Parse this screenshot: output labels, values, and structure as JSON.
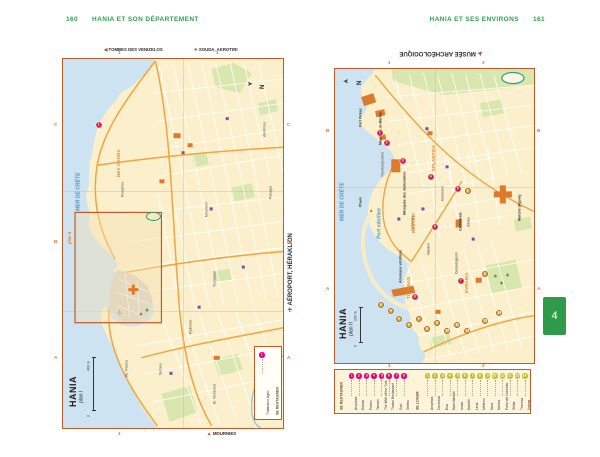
{
  "page": {
    "left_header": {
      "page_number": "160",
      "title": "HANIA ET SON DÉPARTEMENT"
    },
    "right_header": {
      "title": "HANIA ET SES ENVIRONS",
      "page_number": "161"
    },
    "section_tab": "4"
  },
  "colors": {
    "header_green": "#2e9f4d",
    "tab_green": "#2f9b4a",
    "map_border": "#c05a28",
    "sea": "#cde3f1",
    "land": "#fbf0cb",
    "park": "#d9e6ae",
    "building": "#dd7a2c",
    "restaurant_marker": "#e6007e",
    "hotel_marker": "#bcc03a",
    "grid_label": "#e2762d"
  },
  "maps": {
    "left": {
      "title": "HANIA",
      "subtitle": "plan I",
      "compass": "N",
      "scale": {
        "zero": "0",
        "max": "400 m"
      },
      "inset_label": "plan II",
      "edge": {
        "top_left_arrow": "◀",
        "top_left": "TOMBES DES VENIZELOS",
        "top_right_icon": "✈",
        "top_right": "SOUDA, AKROTIRI",
        "right_icon": "✈",
        "right": "AÉROPORT, HÉRAKLION",
        "bottom_icon": "➤",
        "bottom": "MOURNIES"
      },
      "grid": {
        "rows": [
          "C",
          "B",
          "A"
        ],
        "cols": [
          "1",
          "2"
        ]
      },
      "sea_labels": [
        {
          "t": "MER DE CRÈTE",
          "x": 13,
          "y": 152
        }
      ],
      "area_labels": [
        {
          "t": "NEA CHORA",
          "x": 54,
          "y": 118
        }
      ],
      "street_labels": [
        {
          "t": "Kissamou",
          "x": 58,
          "y": 138
        },
        {
          "t": "Akrotiriou",
          "x": 200,
          "y": 78
        },
        {
          "t": "Panagia",
          "x": 206,
          "y": 140
        },
        {
          "t": "Mournion",
          "x": 142,
          "y": 158
        },
        {
          "t": "Tzanakaki",
          "x": 150,
          "y": 228
        },
        {
          "t": "Kydonias",
          "x": 126,
          "y": 275
        },
        {
          "t": "El. Venizelou",
          "x": 150,
          "y": 345
        },
        {
          "t": "Ap. Pavlou",
          "x": 62,
          "y": 318
        },
        {
          "t": "Selinou",
          "x": 96,
          "y": 316
        },
        {
          "t": "Ag. Gogoni",
          "x": 200,
          "y": 308
        }
      ],
      "poi_labels": [],
      "legend": {
        "header": "SE RESTAURER",
        "entries": [
          {
            "n": "1",
            "name": "Thalassino Ageri"
          }
        ]
      },
      "restaurant_markers": [
        {
          "x": 36,
          "y": 66,
          "n": "1"
        }
      ],
      "hotel_markers": []
    },
    "right": {
      "title": "HANIA",
      "subtitle": "plan II",
      "compass": "N",
      "scale": {
        "zero": "0",
        "max": "200 m"
      },
      "edge": {
        "top": "MUSÉE ARCHÉOLOGIQUE",
        "top_icon": "➤"
      },
      "grid": {
        "rows": [
          "B",
          "A"
        ],
        "cols": [
          "1",
          "2"
        ]
      },
      "sea_labels": [
        {
          "t": "MER DE CRÈTE",
          "x": 5,
          "y": 152
        },
        {
          "t": "Port vénitien",
          "x": 42,
          "y": 170
        }
      ],
      "area_labels": [
        {
          "t": "SPLANTZIA",
          "x": 97,
          "y": 102
        },
        {
          "t": "KASTELI",
          "x": 77,
          "y": 164
        },
        {
          "t": "TOPANAS",
          "x": 72,
          "y": 230
        },
        {
          "t": "EVRAIKA",
          "x": 130,
          "y": 224
        }
      ],
      "street_labels": [
        {
          "t": "Theotokopoulou",
          "x": 46,
          "y": 108
        },
        {
          "t": "Kanevaro",
          "x": 106,
          "y": 132
        },
        {
          "t": "Zambeliou",
          "x": 76,
          "y": 162
        },
        {
          "t": "Sifaka",
          "x": 132,
          "y": 158
        },
        {
          "t": "Halidon",
          "x": 92,
          "y": 186
        },
        {
          "t": "Daskalogianni",
          "x": 120,
          "y": 205
        }
      ],
      "poi_labels": [
        {
          "t": "Fort Firkas",
          "x": 24,
          "y": 58
        },
        {
          "t": "Musée de la Marine",
          "x": 44,
          "y": 76
        },
        {
          "t": "Mosquée des Janissaires",
          "x": 68,
          "y": 146
        },
        {
          "t": "Arsenaux vénitiens",
          "x": 64,
          "y": 214
        },
        {
          "t": "Marché (Agora)",
          "x": 183,
          "y": 152
        },
        {
          "t": "Cathédrale",
          "x": 124,
          "y": 162
        },
        {
          "t": "Phare",
          "x": 24,
          "y": 138
        }
      ],
      "restaurant_markers": [
        {
          "x": 45,
          "y": 64,
          "n": "1"
        },
        {
          "x": 52,
          "y": 74,
          "n": "2"
        },
        {
          "x": 68,
          "y": 92,
          "n": "3"
        },
        {
          "x": 96,
          "y": 108,
          "n": "4"
        },
        {
          "x": 123,
          "y": 120,
          "n": "5"
        },
        {
          "x": 100,
          "y": 158,
          "n": "6"
        },
        {
          "x": 126,
          "y": 212,
          "n": "7"
        },
        {
          "x": 80,
          "y": 228,
          "n": "8"
        }
      ],
      "hotel_markers": [
        {
          "x": 133,
          "y": 122,
          "n": "1"
        },
        {
          "x": 150,
          "y": 205,
          "n": "2"
        },
        {
          "x": 46,
          "y": 236,
          "n": "3"
        },
        {
          "x": 56,
          "y": 242,
          "n": "4"
        },
        {
          "x": 64,
          "y": 250,
          "n": "5"
        },
        {
          "x": 74,
          "y": 256,
          "n": "6"
        },
        {
          "x": 84,
          "y": 250,
          "n": "7"
        },
        {
          "x": 92,
          "y": 260,
          "n": "8"
        },
        {
          "x": 102,
          "y": 254,
          "n": "9"
        },
        {
          "x": 112,
          "y": 262,
          "n": "10"
        },
        {
          "x": 122,
          "y": 256,
          "n": "11"
        },
        {
          "x": 132,
          "y": 262,
          "n": "12"
        },
        {
          "x": 150,
          "y": 252,
          "n": "13"
        },
        {
          "x": 164,
          "y": 244,
          "n": "14"
        }
      ]
    }
  },
  "legend_box": {
    "restaurants": {
      "header": "SE RESTAURER",
      "items": [
        "Amphora",
        "Kostas",
        "Portes",
        "Tamam",
        "The Well of the Turk",
        "Tholos Restaurant",
        "Suki",
        "Stelios"
      ]
    },
    "hotels": {
      "header": "SE LOGER",
      "items": [
        "Amphora",
        "Contessa",
        "Eva",
        "Hotel Afroditi",
        "Ionas",
        "Kastelli",
        "Lena",
        "Meltemi",
        "Nora",
        "Nostos",
        "Porto del Colombo",
        "Stella",
        "Theresa",
        "Vranas"
      ]
    }
  }
}
